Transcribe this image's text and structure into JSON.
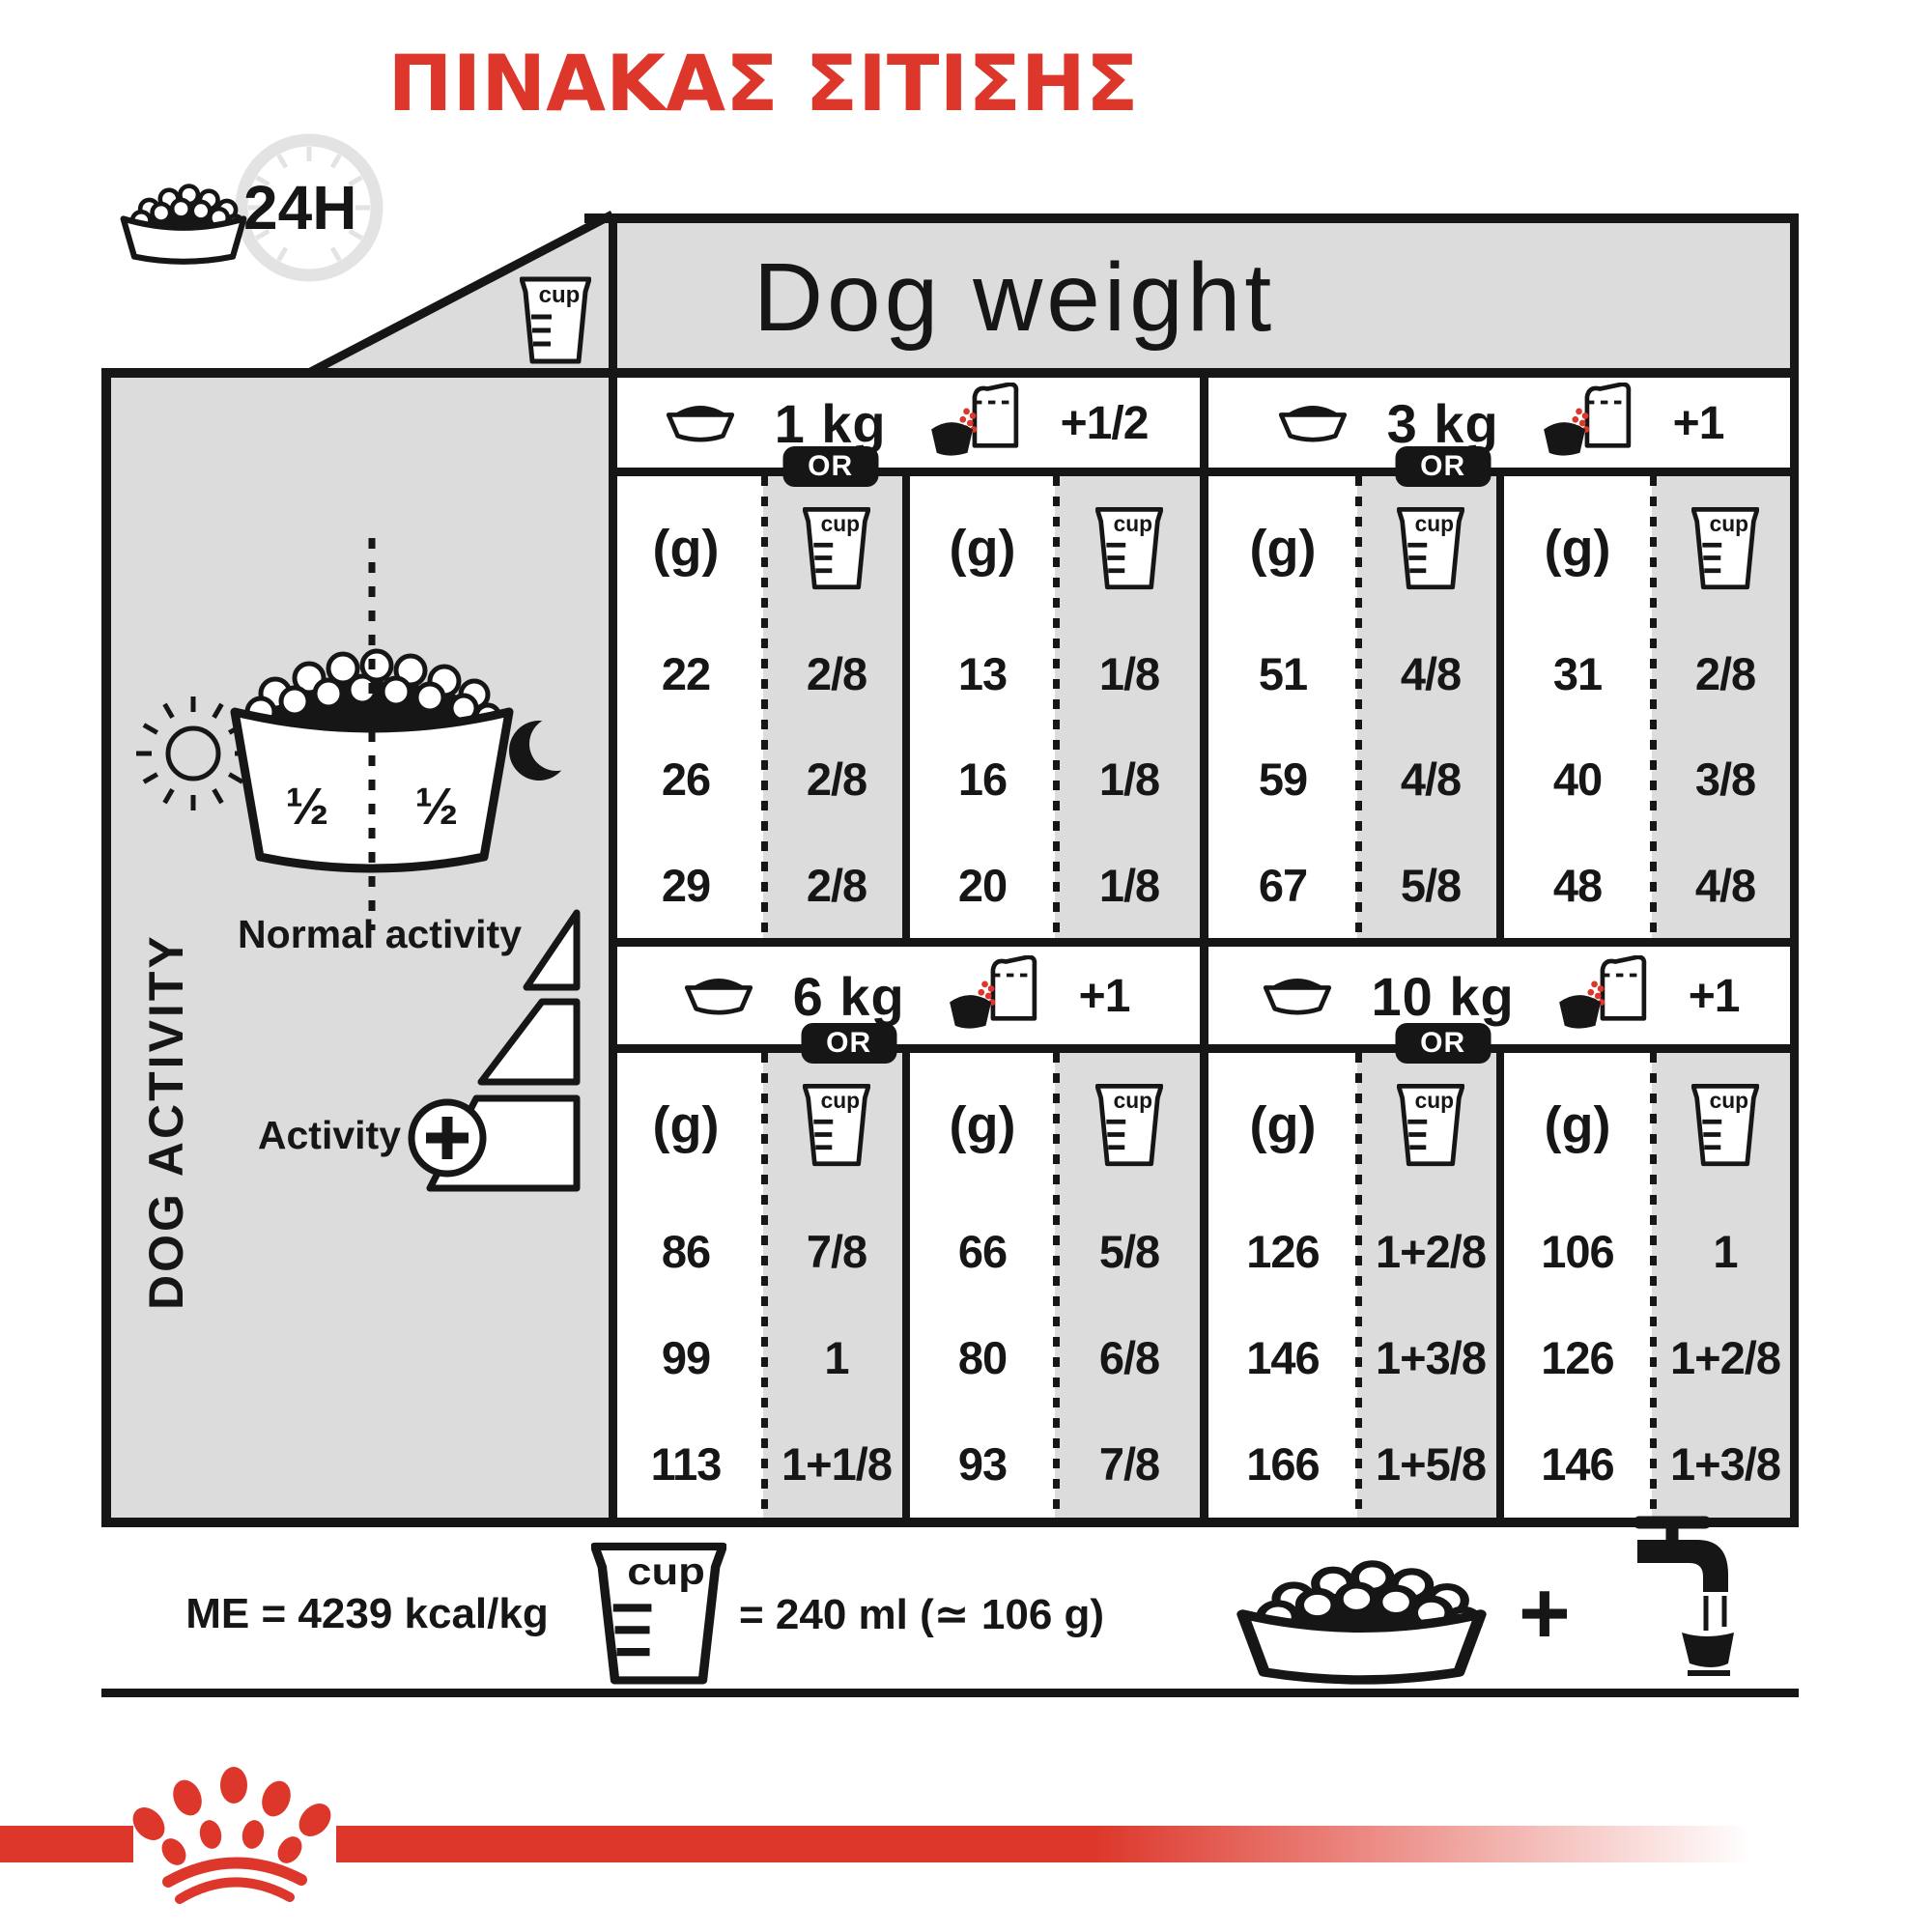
{
  "title": "ΠΙΝΑΚΑΣ ΣΙΤΙΣΗΣ",
  "labels": {
    "hours": "24H",
    "cup": "cup",
    "dog_weight": "Dog weight",
    "or": "OR",
    "grams": "(g)"
  },
  "sidebar": {
    "title": "DOG ACTIVITY",
    "normal_activity": "Normal activity",
    "activity": "Activity",
    "half_left": "½",
    "half_right": "½"
  },
  "sections": [
    {
      "weight": "1 kg",
      "wet_add": "+1/2",
      "dry_g": [
        "22",
        "26",
        "29"
      ],
      "dry_cup": [
        "2/8",
        "2/8",
        "2/8"
      ],
      "wet_g": [
        "13",
        "16",
        "20"
      ],
      "wet_cup": [
        "1/8",
        "1/8",
        "1/8"
      ]
    },
    {
      "weight": "3 kg",
      "wet_add": "+1",
      "dry_g": [
        "51",
        "59",
        "67"
      ],
      "dry_cup": [
        "4/8",
        "4/8",
        "5/8"
      ],
      "wet_g": [
        "31",
        "40",
        "48"
      ],
      "wet_cup": [
        "2/8",
        "3/8",
        "4/8"
      ]
    },
    {
      "weight": "6 kg",
      "wet_add": "+1",
      "dry_g": [
        "86",
        "99",
        "113"
      ],
      "dry_cup": [
        "7/8",
        "1",
        "1+1/8"
      ],
      "wet_g": [
        "66",
        "80",
        "93"
      ],
      "wet_cup": [
        "5/8",
        "6/8",
        "7/8"
      ]
    },
    {
      "weight": "10 kg",
      "wet_add": "+1",
      "dry_g": [
        "126",
        "146",
        "166"
      ],
      "dry_cup": [
        "1+2/8",
        "1+3/8",
        "1+5/8"
      ],
      "wet_g": [
        "106",
        "126",
        "146"
      ],
      "wet_cup": [
        "1",
        "1+2/8",
        "1+3/8"
      ]
    }
  ],
  "footer": {
    "me": "ME = 4239 kcal/kg",
    "cup_equiv": "= 240 ml (≃ 106 g)",
    "plus": "+"
  },
  "colors": {
    "red": "#dd372b",
    "gray": "#dcdcdc",
    "black": "#161616"
  }
}
